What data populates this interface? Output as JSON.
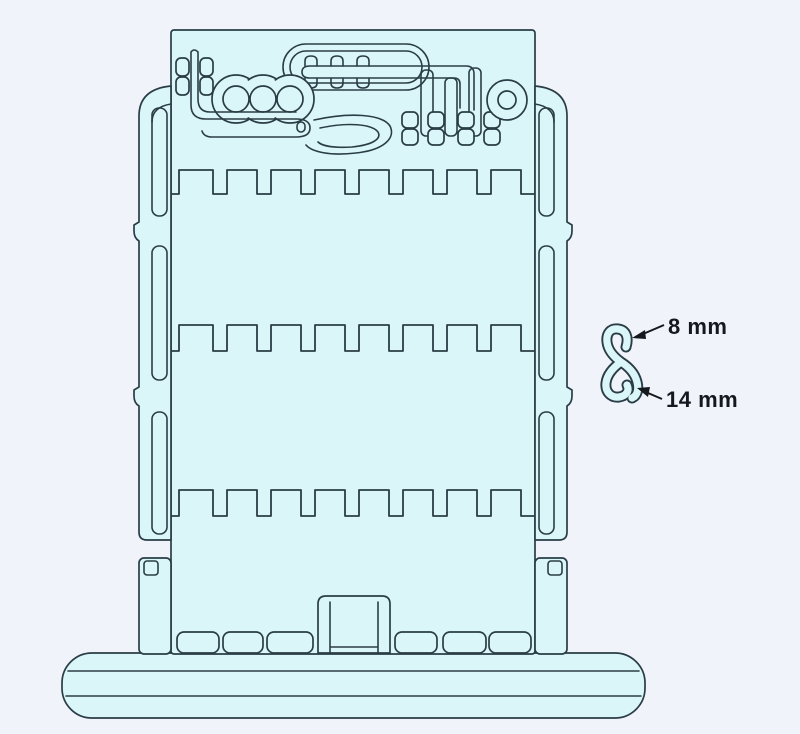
{
  "diagram": {
    "colors": {
      "background": "#f1f3fa",
      "part_fill": "#dbf6f9",
      "line_color": "#2a3d46",
      "annotation_text": "#15181c"
    },
    "annotations": [
      {
        "label": "8 mm"
      },
      {
        "label": "14 mm"
      }
    ]
  }
}
